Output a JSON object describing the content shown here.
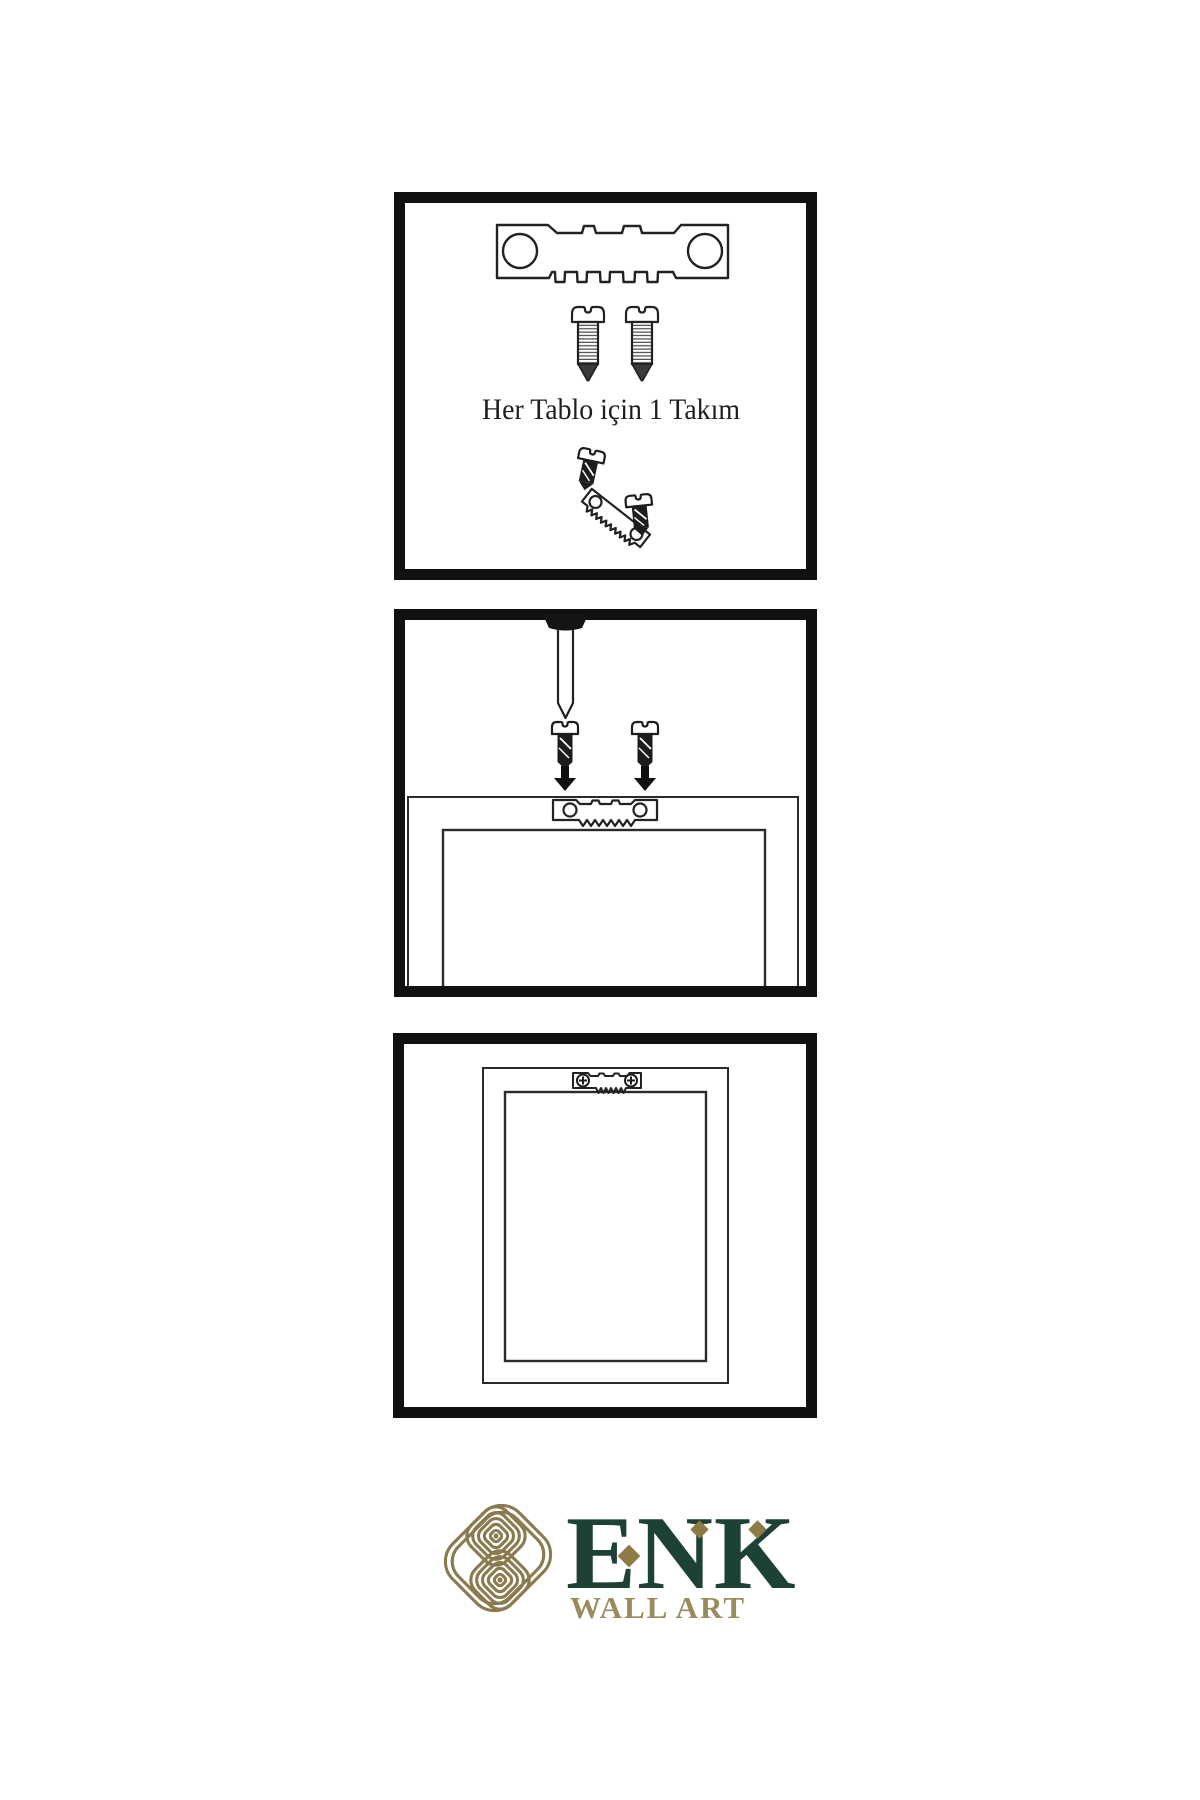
{
  "sheet": {
    "background": "#ffffff",
    "line_color": "#222222",
    "panels": [
      {
        "id": "hardware-kit",
        "caption": "Her Tablo için 1 Takım",
        "items": [
          "sawtooth-hanger",
          "screw",
          "screw",
          "screw-angled-into-hanger",
          "screw-beside-hanger"
        ]
      },
      {
        "id": "mounting-steps",
        "items": [
          "wall-nail",
          "screw-with-down-arrow",
          "screw-with-down-arrow",
          "frame-back",
          "sawtooth-hanger-mounted"
        ]
      },
      {
        "id": "hanging-result",
        "items": [
          "framed-picture",
          "sawtooth-hanger-screwed"
        ]
      }
    ]
  },
  "logo": {
    "brand": "ENK",
    "subtitle": "WALL ART",
    "colors": {
      "brand_green": "#1d4136",
      "knot_gold": "#8a7a4e",
      "subtitle_gold": "#9a8a5c",
      "diamond_gold": "#8e7a45"
    }
  }
}
